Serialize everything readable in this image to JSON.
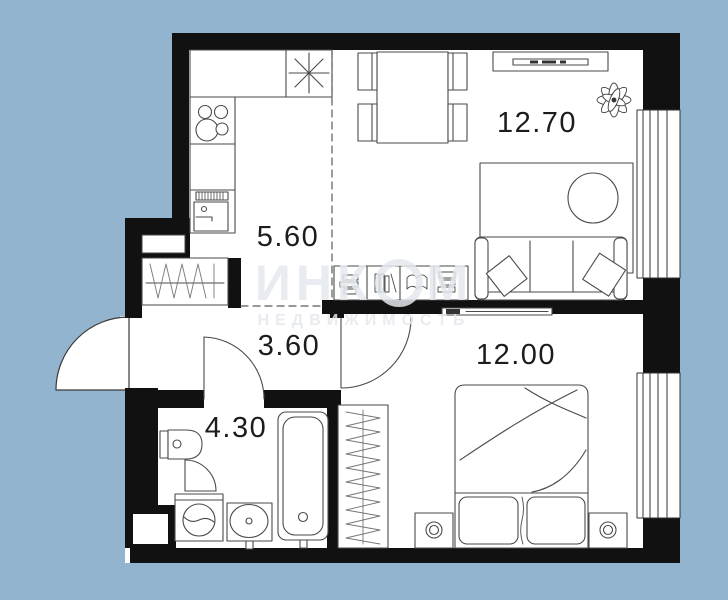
{
  "background_color": "#92b4cf",
  "wall_color": "#111111",
  "rooms": {
    "living": {
      "area": "12.70"
    },
    "kitchen": {
      "area": "5.60"
    },
    "hallway": {
      "area": "3.60"
    },
    "bathroom": {
      "area": "4.30"
    },
    "bedroom": {
      "area": "12.00"
    }
  },
  "watermark": {
    "brand_part1": "ИНК",
    "brand_part2": "М",
    "subtitle": "НЕДВИЖИМОСТЬ"
  }
}
